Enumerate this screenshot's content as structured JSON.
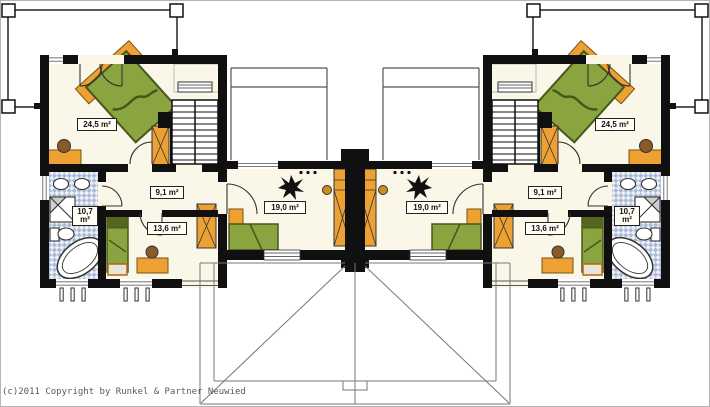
{
  "footer": {
    "copyright": "(c)2011 Copyright by Runkel & Partner Neuwied"
  },
  "units": [
    {
      "side": "left",
      "rooms": [
        {
          "name": "bedroom-large",
          "area": "24,5 m²"
        },
        {
          "name": "hallway",
          "area": "9,1 m²"
        },
        {
          "name": "bedroom-small",
          "area": "13,6 m²"
        },
        {
          "name": "bathroom",
          "area": "10,7 m²"
        },
        {
          "name": "living-room",
          "area": "19,0 m²"
        }
      ]
    },
    {
      "side": "right",
      "rooms": [
        {
          "name": "bedroom-large",
          "area": "24,5 m²"
        },
        {
          "name": "hallway",
          "area": "9,1 m²"
        },
        {
          "name": "bedroom-small",
          "area": "13,6 m²"
        },
        {
          "name": "bathroom",
          "area": "10,7 m²"
        },
        {
          "name": "living-room",
          "area": "19,0 m²"
        }
      ]
    }
  ],
  "palette": {
    "wall": "#101010",
    "floor": "#faf7e8",
    "furniture_orange": "#eda133",
    "bed_green": "#8aa53f",
    "bed_green_dark": "#47571b",
    "tile_blue": "#a9b9d6",
    "roof_line": "#777777",
    "person_brown": "#8a5a28"
  }
}
